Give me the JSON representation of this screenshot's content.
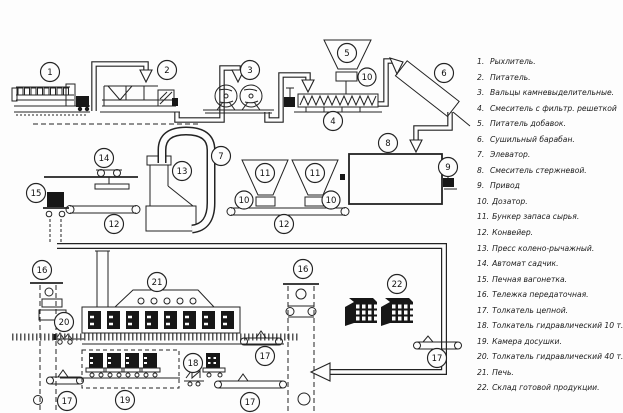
{
  "legend": {
    "items": [
      {
        "num": "1.",
        "label": "Рыхлитель."
      },
      {
        "num": "2.",
        "label": "Питатель."
      },
      {
        "num": "3.",
        "label": "Вальцы камневыделительные."
      },
      {
        "num": "4.",
        "label": "Смеситель с фильтр. решеткой"
      },
      {
        "num": "5.",
        "label": "Питатель добавок."
      },
      {
        "num": "6.",
        "label": "Сушильный барабан."
      },
      {
        "num": "7.",
        "label": "Элеватор."
      },
      {
        "num": "8.",
        "label": "Смеситель стержневой."
      },
      {
        "num": "9.",
        "label": "Привод"
      },
      {
        "num": "10.",
        "label": "Дозатор."
      },
      {
        "num": "11.",
        "label": "Бункер запаса сырья."
      },
      {
        "num": "12.",
        "label": "Конвейер."
      },
      {
        "num": "13.",
        "label": "Пресс колено-рычажный."
      },
      {
        "num": "14.",
        "label": "Автомат садчик."
      },
      {
        "num": "15.",
        "label": "Печная вагонетка."
      },
      {
        "num": "16.",
        "label": "Тележка передаточная."
      },
      {
        "num": "17.",
        "label": "Толкатель цепной."
      },
      {
        "num": "18.",
        "label": "Толкатель гидравлический 10 т."
      },
      {
        "num": "19.",
        "label": "Камера досушки."
      },
      {
        "num": "20.",
        "label": "Толкатель гидравлический 40 т."
      },
      {
        "num": "21.",
        "label": "Печь."
      },
      {
        "num": "22.",
        "label": "Склад готовой продукции."
      }
    ]
  },
  "diagram": {
    "callouts": {
      "n1": "1",
      "n2": "2",
      "n3": "3",
      "n4": "4",
      "n5": "5",
      "n6": "6",
      "n7": "7",
      "n8": "8",
      "n9": "9",
      "n10": "10",
      "n11": "11",
      "n12": "12",
      "n13": "13",
      "n14": "14",
      "n15": "15",
      "n16": "16",
      "n17": "17",
      "n18": "18",
      "n19": "19",
      "n20": "20",
      "n21": "21",
      "n22": "22"
    }
  }
}
